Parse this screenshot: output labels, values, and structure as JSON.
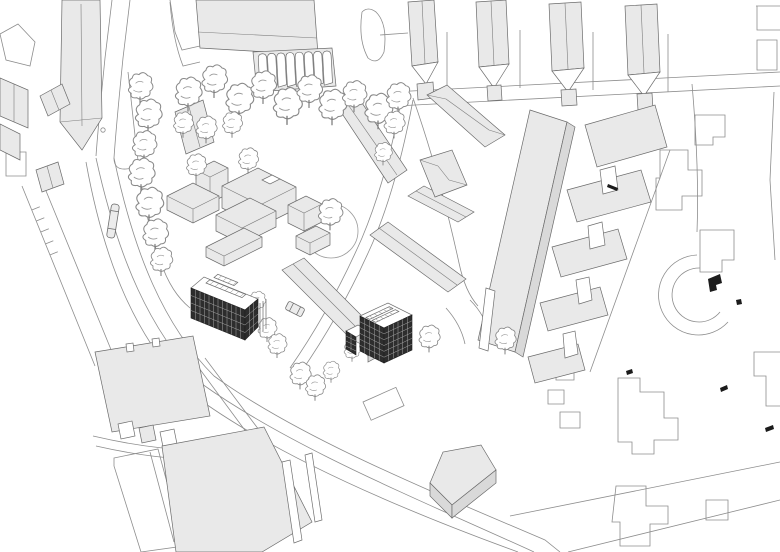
{
  "document": {
    "kind": "architectural axonometric site plan",
    "style": "black-and-white line drawing with light gray building masses",
    "visible_text": "none"
  },
  "palette": {
    "background": "#ffffff",
    "linework": "#8d8d8d",
    "linework_dark": "#5f5f5f",
    "mass_fill": "#e9e9e9",
    "mass_side_fill": "#d9d9d9",
    "white_fill": "#ffffff",
    "proposed_facade": "#2d2d2d",
    "proposed_grid": "#a6a6a6",
    "proposed_roof_panel": "#c9c9c9",
    "black_accent": "#1b1b1b",
    "tree_stroke": "#8a8a8a"
  },
  "scene": {
    "proposed_buildings": [
      {
        "id": "proposed-building-west",
        "visible_floors": 4,
        "facade": "dark gridded window facade facing southwest",
        "roof": "white roof with skylight strips"
      },
      {
        "id": "proposed-building-east",
        "visible_floors": 5,
        "facade": "dark gridded window facades on two sides",
        "roof": "white roof with skylight strips"
      }
    ],
    "context": {
      "row_houses_north_count": 4,
      "barrel_roof_units_count": 8,
      "campus_slab_rows_east_count": 5,
      "tree_count": 34,
      "vehicle_count": 2,
      "landmark": "circular tree-canopy ring at the center green",
      "roads": "curved perimeter streets and a wide diagonal boulevard to the south"
    }
  }
}
